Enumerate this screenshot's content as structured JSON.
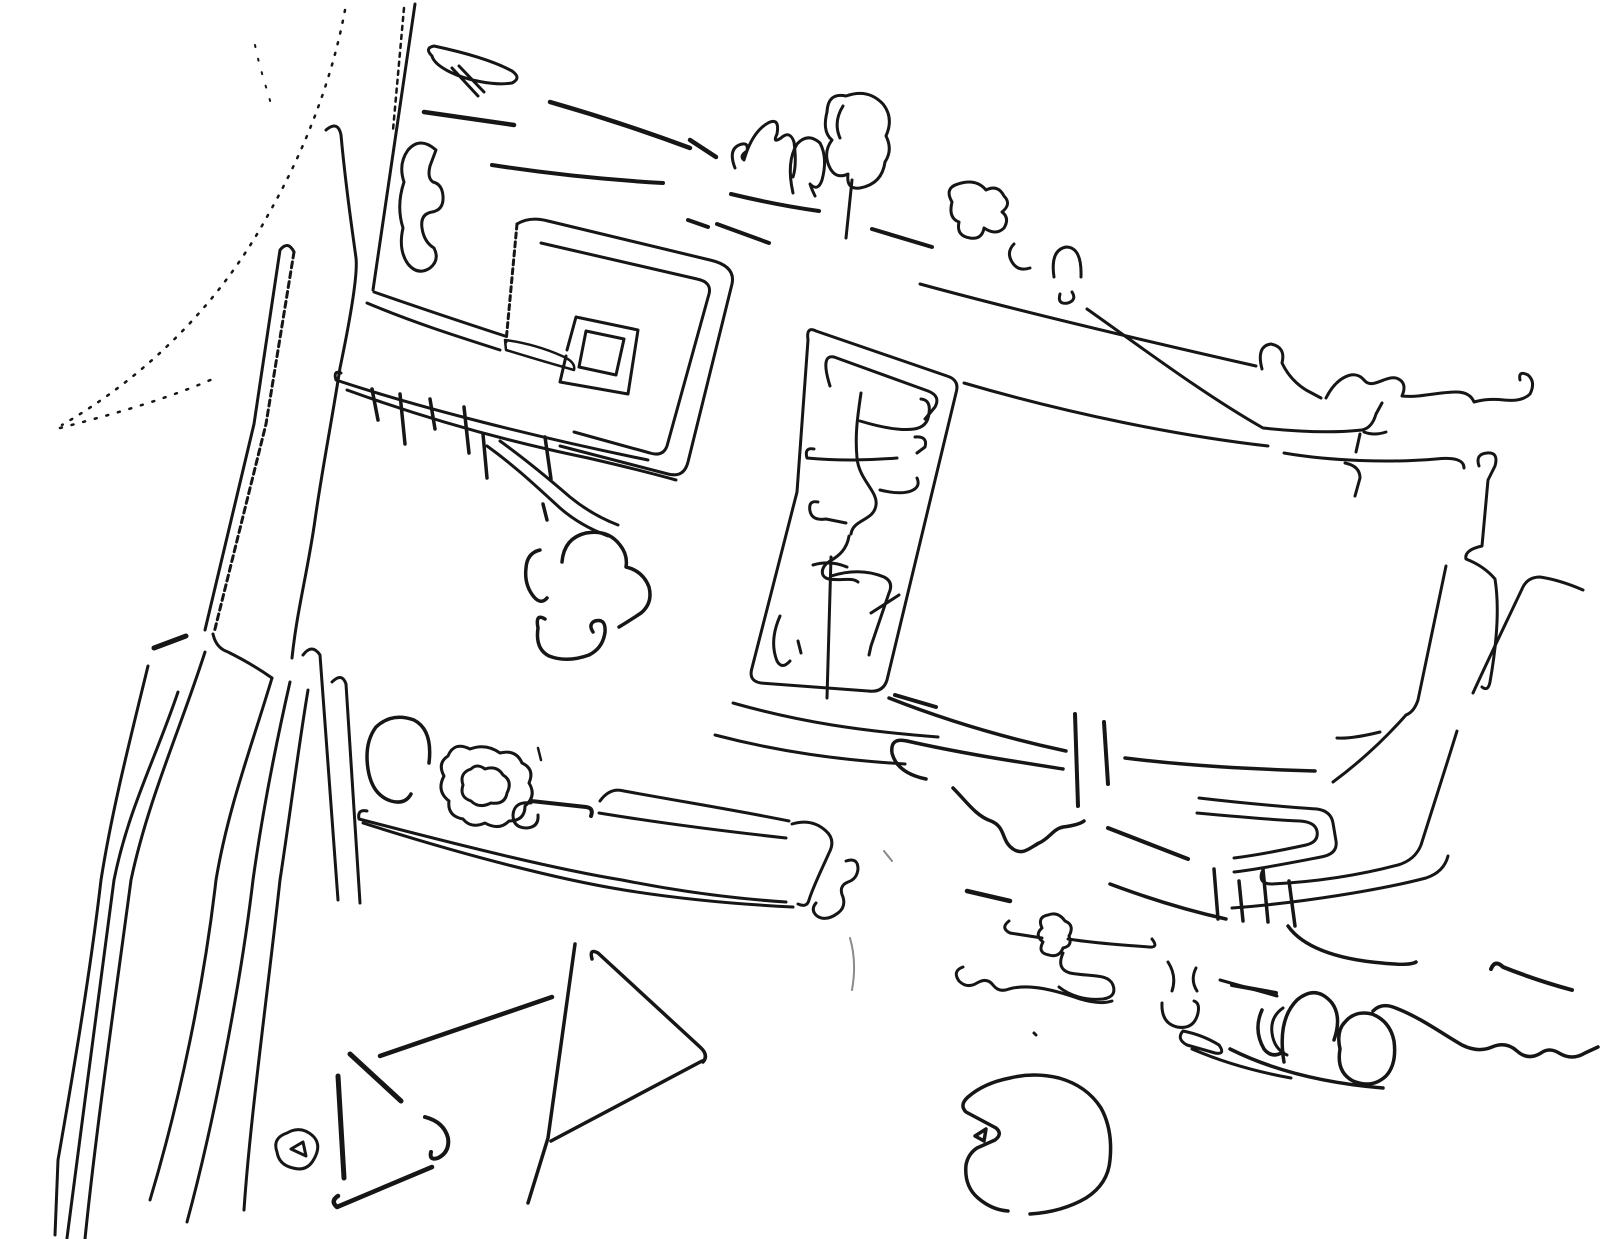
{
  "meta": {
    "background_color": "#ffffff",
    "stroke_color": "#161616",
    "canvas_width": 1600,
    "canvas_height": 1239
  },
  "drawing": {
    "default_stroke_width": 3,
    "paths": [
      {
        "name": "dotted-arc-main",
        "d": "M345,10 C332,80 305,150 268,215 C230,285 165,365 62,425",
        "w": 2.5,
        "dash": "2 9"
      },
      {
        "name": "dotted-arc-lower",
        "d": "M60,428 C110,415 165,400 215,378",
        "w": 2.5,
        "dash": "2 10"
      },
      {
        "name": "dotted-bits-top",
        "d": "M255,45 C260,70 268,92 272,108",
        "w": 2,
        "dash": "2 12"
      },
      {
        "name": "road-left-median-a",
        "d": "M294,252 Q288,240 280,250 L254,424 L205,630",
        "w": 3
      },
      {
        "name": "road-left-median-b",
        "d": "M294,252 L266,424 L214,633",
        "w": 3,
        "dash": "6 4"
      },
      {
        "name": "road-left-right-edge",
        "d": "M326,130 Q338,120 341,135 C346,190 352,228 356,258 C358,275 350,320 340,368 C332,420 322,470 315,520 C308,570 297,610 292,658",
        "w": 3
      },
      {
        "name": "road-left-diagonal",
        "d": "M415,4 L373,290",
        "w": 3
      },
      {
        "name": "road-left-diagonal-edge",
        "d": "M404,8 L393,130",
        "w": 2.5,
        "dash": "4 5"
      },
      {
        "name": "junction-dash",
        "d": "M154,648 L186,636",
        "w": 5
      },
      {
        "name": "junction-link",
        "d": "M213,634 Q216,648 228,652 C244,660 258,668 272,678",
        "w": 3
      },
      {
        "name": "lower-band-1",
        "d": "M148,666 C130,740 112,810 101,880 C90,975 72,1080 58,1160 L55,1235",
        "w": 3
      },
      {
        "name": "lower-band-2",
        "d": "M178,692 C155,760 128,810 114,880 C100,990 82,1120 67,1238",
        "w": 3
      },
      {
        "name": "lower-band-3",
        "d": "M205,652 C180,730 148,800 131,880 C115,1000 96,1130 85,1239",
        "w": 3
      },
      {
        "name": "lower-band-4",
        "d": "M272,678 C252,745 228,808 216,880 C204,985 180,1100 150,1200",
        "w": 3
      },
      {
        "name": "lower-band-5",
        "d": "M290,682 C275,748 262,815 253,880 C240,990 212,1130 187,1222",
        "w": 3
      },
      {
        "name": "lower-band-6",
        "d": "M308,690 C298,750 290,815 280,880 C268,990 250,1120 244,1210",
        "w": 3
      },
      {
        "name": "lower-band-7",
        "d": "M303,655 Q312,643 320,655 L338,900",
        "w": 3
      },
      {
        "name": "lower-band-8",
        "d": "M332,682 Q342,672 346,684 L360,903",
        "w": 3
      },
      {
        "name": "spiral-outer",
        "d": "M517,224 Q530,216 548,221 L710,260 Q736,266 732,284 L688,462 Q684,478 668,474 L560,446",
        "w": 3
      },
      {
        "name": "spiral-left-edge",
        "d": "M517,224 L506,342",
        "w": 3,
        "dash": "5 4"
      },
      {
        "name": "spiral-sliver",
        "d": "M505,340 Q535,344 562,356 Q576,362 574,370 Q545,362 506,350 Z",
        "w": 2.5
      },
      {
        "name": "spiral-mid-ring",
        "d": "M541,243 L697,279 Q712,282 709,294 L667,446 Q663,457 650,453 L574,432",
        "w": 3
      },
      {
        "name": "spiral-inner-square",
        "d": "M567,350 L576,317 L638,330 L628,394 L560,382 L566,356",
        "w": 3
      },
      {
        "name": "spiral-inner-hole",
        "d": "M586,331 L624,339 L616,375 L579,367 Z",
        "w": 3
      },
      {
        "name": "band-junction-spiral-a",
        "d": "M374,292 C420,308 462,322 505,336",
        "w": 3
      },
      {
        "name": "band-junction-spiral-b",
        "d": "M367,303 C412,322 456,336 500,350",
        "w": 3
      },
      {
        "name": "band-lower-a",
        "d": "M341,373 Q333,370 336,380 C420,408 540,438 648,460",
        "w": 3
      },
      {
        "name": "band-lower-b",
        "d": "M347,390 C430,420 510,442 588,458 Q640,470 676,480",
        "w": 3
      },
      {
        "name": "band-ext-a",
        "d": "M487,446 C515,466 538,488 560,508 C576,522 592,530 608,536",
        "w": 3
      },
      {
        "name": "band-ext-b",
        "d": "M500,441 C525,459 548,478 570,497 Q592,515 618,525",
        "w": 3
      },
      {
        "name": "hanging-legs",
        "d": "M372,389 L378,420 M400,394 L405,444 M430,399 L435,429 M464,407 L469,453 M483,434 L487,478 M545,437 L551,479 M543,504 L547,520",
        "w": 3.5
      },
      {
        "name": "top-road-dash-1",
        "d": "M424,112 L514,125",
        "w": 4.5
      },
      {
        "name": "top-road-dash-2",
        "d": "M550,102 Q620,122 690,148",
        "w": 4.5
      },
      {
        "name": "top-road-dash-3",
        "d": "M492,165 C550,174 610,180 663,183",
        "w": 4
      },
      {
        "name": "top-road-dash-4",
        "d": "M690,140 L716,157",
        "w": 4.5
      },
      {
        "name": "top-road-dash-5",
        "d": "M731,194 C760,201 790,207 819,211",
        "w": 4
      },
      {
        "name": "top-road-dash-6",
        "d": "M688,220 L708,227",
        "w": 4
      },
      {
        "name": "top-road-dash-7",
        "d": "M717,224 C736,231 753,237 769,243",
        "w": 4
      },
      {
        "name": "top-road-dash-8",
        "d": "M872,229 L932,247",
        "w": 4
      },
      {
        "name": "long-line-upper",
        "d": "M920,284 C1030,314 1150,342 1256,366 M1262,369 Q1256,346 1271,344 Q1286,347 1282,363 Q1290,380 1306,390 L1321,398",
        "w": 3
      },
      {
        "name": "long-line-mid",
        "d": "M1087,309 C1145,350 1205,395 1263,428 C1300,432 1335,433 1362,430 M1362,430 Q1372,428 1376,414 L1382,403 M1364,432 Q1374,436 1386,432 M1360,434 L1356,452",
        "w": 3
      },
      {
        "name": "long-line-lower",
        "d": "M964,383 C1070,414 1180,436 1268,446 M1284,453 C1330,461 1390,463 1436,459 Q1464,456 1464,468",
        "w": 3
      },
      {
        "name": "hook-down-mid",
        "d": "M1345,463 Q1360,466 1360,478 L1355,496",
        "w": 3
      },
      {
        "name": "wiggle-right-top",
        "d": "M1326,398 C1336,378 1354,368 1364,380 C1372,390 1384,376 1396,378 Q1408,382 1402,396 C1418,398 1438,392 1456,392 Q1470,392 1474,402 Q1488,398 1504,400 Q1522,402 1530,394 Q1536,382 1528,375 Q1518,370 1520,380",
        "w": 3
      },
      {
        "name": "tree-curl",
        "d": "M436,150 Q420,136 408,150 Q398,164 404,182 Q396,206 403,228 Q398,250 408,264 Q418,276 430,268 Q440,260 434,248 Q424,242 422,228 Q420,214 432,212 Q444,210 443,196 Q442,184 433,182 Q427,178 430,166 Z",
        "w": 3
      },
      {
        "name": "tree-hook-blob",
        "d": "M432,56 Q424,48 434,46 C462,52 492,60 512,71 Q522,78 512,83 C494,86 466,80 450,72 Q434,64 432,56 Z M452,68 L478,96 M459,66 L484,92",
        "w": 3
      },
      {
        "name": "tree-two-bump",
        "d": "M735,168 Q728,150 739,145 Q749,141 747,151 Q739,156 744,160 Q752,132 768,123 Q780,117 777,134 Q772,144 781,138 Q790,130 794,142 Q797,165 793,177",
        "w": 3
      },
      {
        "name": "tree-arch",
        "d": "M793,193 Q786,162 797,144 Q808,132 820,143 Q828,158 822,180 Q818,192 810,184 Q812,190 815,196",
        "w": 3
      },
      {
        "name": "tree-big-blob",
        "d": "M846,96 Q828,92 827,112 Q822,132 832,140 Q823,152 829,166 Q835,180 848,174 Q846,190 860,188 Q882,184 885,162 Q893,150 886,136 Q894,118 883,104 Q868,88 846,96 Z M843,106 Q833,122 840,138 M852,180 L846,238",
        "w": 3
      },
      {
        "name": "tree-cluster-right",
        "d": "M952,202 Q944,188 958,184 Q976,178 986,190 Q998,184 1004,196 Q1012,204 1002,212 Q1010,218 1004,228 Q996,236 984,228 Q982,240 970,238 Q956,236 959,222 Q948,218 952,202 Z M1014,244 Q1006,252 1012,262 Q1018,272 1030,268 M1054,277 Q1050,250 1066,247 Q1082,247 1081,277 M1060,294 Q1057,305 1068,303 Q1077,300 1072,292",
        "w": 3
      },
      {
        "name": "parcel-outline",
        "d": "M816,331 Q806,326 808,340 L797,492 L752,668 Q748,681 761,683 L868,691 Q883,693 887,680 L956,393 Q960,380 947,376 Z",
        "w": 3
      },
      {
        "name": "parcel-top-bar",
        "d": "M830,386 Q820,354 834,357 L928,391 Q941,396 935,407 L925,419",
        "w": 3
      },
      {
        "name": "parcel-branches-upper",
        "d": "M861,393 C857,420 855,436 857,458 C859,480 878,491 876,505 C874,521 853,519 851,534 M860,421 C880,427 900,431 914,429 Q928,427 929,413 Q931,400 921,399 M814,449 Q804,447 807,458 Q850,462 897,458 M915,437 Q928,436 925,447 L917,453 M880,490 Q900,495 911,491 Q921,487 917,478 M818,502 Q808,500 810,511 Q812,521 826,519 L846,523",
        "w": 3
      },
      {
        "name": "parcel-mid-squiggle",
        "d": "M849,536 C847,549 839,556 830,561 C821,566 819,577 829,579 C841,581 852,577 858,582",
        "w": 3
      },
      {
        "name": "parcel-wishbone",
        "d": "M831,557 L827,698 M831,576 Q860,567 884,577 Q894,582 889,593 L871,646 L869,655 M871,613 L899,595 M813,565 Q830,560 847,567",
        "w": 3
      },
      {
        "name": "parcel-left-curve",
        "d": "M780,616 Q769,641 777,661 Q782,670 790,661 M798,641 L801,653",
        "w": 3
      },
      {
        "name": "parcel-bottom-line-1",
        "d": "M733,703 C800,722 860,731 938,737",
        "w": 3
      },
      {
        "name": "parcel-bottom-line-2",
        "d": "M715,735 C780,752 840,760 905,764",
        "w": 3
      },
      {
        "name": "parcel-bottom-dash",
        "d": "M895,695 L936,707",
        "w": 4
      },
      {
        "name": "road-mr-1",
        "d": "M889,698 C950,722 1010,739 1066,751",
        "w": 3.5
      },
      {
        "name": "road-mr-hook",
        "d": "M926,779 Q897,773 892,753 Q890,737 907,741 C960,753 1012,761 1063,769",
        "w": 3.5
      },
      {
        "name": "road-mr-right",
        "d": "M1125,758 C1190,766 1250,769 1315,771",
        "w": 3.5
      },
      {
        "name": "bar-vertical-1",
        "d": "M1075,714 L1078,806",
        "w": 4
      },
      {
        "name": "bar-vertical-2",
        "d": "M1104,722 L1108,784",
        "w": 4
      },
      {
        "name": "wavy-wm",
        "d": "M953,788 C966,801 976,816 991,821 C1006,827 1001,841 1013,849 C1023,856 1031,847 1039,843 C1049,839 1053,829 1063,827 Q1079,825 1084,821",
        "w": 3.5
      },
      {
        "name": "dash-diагonal-mr",
        "d": "M1108,828 L1188,859",
        "w": 4
      },
      {
        "name": "step-band-a",
        "d": "M1199,798 C1250,804 1300,808 1317,809 Q1331,811 1333,823 L1336,841 Q1338,854 1321,857 C1290,863 1260,869 1234,872",
        "w": 3
      },
      {
        "name": "step-band-b",
        "d": "M1197,813 C1240,817 1275,820 1300,821 Q1315,822 1317,831 Q1319,842 1306,845 C1283,850 1258,855 1234,858",
        "w": 3
      },
      {
        "name": "bottom-line-mr",
        "d": "M1110,884 C1150,899 1190,911 1226,919",
        "w": 3.5
      },
      {
        "name": "stubs-vertical",
        "d": "M1214,869 L1218,919 M1239,881 L1243,921",
        "w": 3.5
      },
      {
        "name": "field-right-edge",
        "d": "M1446,566 L1418,700 Q1414,712 1406,715 C1384,740 1360,762 1333,782",
        "w": 3
      },
      {
        "name": "field-right-inner",
        "d": "M1380,732 Q1352,739 1337,738",
        "w": 3
      },
      {
        "name": "field-right-branch",
        "d": "M1457,731 C1445,770 1432,810 1421,845 Q1415,860 1398,865 C1360,875 1315,882 1272,884 Q1258,884 1262,872",
        "w": 3
      },
      {
        "name": "field-right-branch-b",
        "d": "M1448,856 Q1444,872 1426,878 C1380,890 1300,903 1232,908",
        "w": 3
      },
      {
        "name": "shape-five",
        "d": "M1479,466 Q1475,454 1487,453 Q1499,452 1495,466 L1488,480 L1482,546 Q1464,550 1466,559 Q1484,566 1495,579 C1500,610 1496,648 1490,682 Q1488,692 1482,687",
        "w": 3
      },
      {
        "name": "elbow-right",
        "d": "M1583,590 Q1560,580 1540,577 Q1527,577 1522,589 C1505,625 1488,660 1473,693",
        "w": 3
      },
      {
        "name": "ring-open",
        "d": "M429,763 Q433,730 414,720 Q392,712 376,727 Q364,743 368,769 Q372,795 391,801 Q405,805 411,794",
        "w": 3.5
      },
      {
        "name": "flower-outer",
        "d": "M470,749 Q454,741 448,756 Q437,763 444,776 Q436,791 449,801 Q447,816 463,819 Q471,829 485,823 Q499,831 509,821 Q525,821 525,806 Q537,796 529,783 Q535,769 522,763 Q516,749 500,753 Q486,743 470,749 Z",
        "w": 3
      },
      {
        "name": "flower-hole",
        "d": "M471,769 Q459,773 463,785 Q459,797 471,801 Q479,809 491,803 Q505,805 507,793 Q513,781 503,775 Q497,765 485,769 Q477,763 471,769 Z",
        "w": 3
      },
      {
        "name": "small-circle",
        "d": "M531,803 Q514,801 513,815 Q513,828 527,828 Q539,827 538,815",
        "w": 3
      },
      {
        "name": "bar-from-flower",
        "d": "M531,801 L586,807 Q594,808 591,816",
        "w": 4
      },
      {
        "name": "tiny-tick",
        "d": "M538,748 L541,760",
        "w": 2.5
      },
      {
        "name": "road-up-a",
        "d": "M600,801 Q610,787 624,791 C690,803 740,811 789,821",
        "w": 3
      },
      {
        "name": "road-up-b",
        "d": "M599,813 C660,823 722,831 786,838",
        "w": 3
      },
      {
        "name": "s-hook-road-end",
        "d": "M792,824 Q812,818 826,831 Q836,840 829,853 C821,871 813,887 809,900 Q807,908 798,904",
        "w": 3
      },
      {
        "name": "road-low-a",
        "d": "M367,811 Q357,809 359,819 C470,848 560,870 622,880 C682,892 740,899 786,902",
        "w": 3
      },
      {
        "name": "road-low-b",
        "d": "M363,823 C470,857 562,880 624,890 C680,899 732,904 793,907",
        "w": 3
      },
      {
        "name": "squiggle-tail",
        "d": "M846,861 Q858,857 858,869 Q857,879 848,882 Q838,886 843,897 Q846,907 838,913 Q826,922 817,916 Q810,910 816,903",
        "w": 3
      },
      {
        "name": "trefoil-blob",
        "d": "M540,550 Q527,553 526,568 Q524,585 534,597 Q541,605 547,598 M562,562 Q564,538 586,533 Q608,529 620,545 Q628,555 626,567 Q643,571 649,587 Q653,603 641,613 Q629,621 619,627 M545,619 Q535,613 538,628 Q535,649 549,656 Q567,663 589,655 Q603,648 605,632 Q606,618 595,621 Q588,624 593,632",
        "w": 3.5
      },
      {
        "name": "triangle-small",
        "d": "M277,1152 Q272,1138 287,1133 Q301,1125 313,1136 Q322,1145 314,1159 Q307,1172 293,1168 Q279,1165 277,1152 Z M291,1149 L303,1142 L306,1156 Z",
        "w": 3
      },
      {
        "name": "bar-bottom-left",
        "d": "M338,1076 L344,1178",
        "w": 5
      },
      {
        "name": "dash-diag-bl",
        "d": "M350,1054 L401,1101",
        "w": 5
      },
      {
        "name": "long-diag-bl",
        "d": "M380,1056 L552,997",
        "w": 4.5
      },
      {
        "name": "hook-bl",
        "d": "M425,1117 Q444,1122 448,1138 Q450,1152 438,1158 Q429,1161 431,1152",
        "w": 4
      },
      {
        "name": "dash-bottom-bl",
        "d": "M338,1196 Q330,1201 337,1207 L432,1167",
        "w": 4.5
      },
      {
        "name": "triangle-left-line",
        "d": "M575,944 L548,1138 L528,1203",
        "w": 3.5
      },
      {
        "name": "triangle-top-side",
        "d": "M592,959 Q589,948 598,953 L700,1047 Q709,1055 703,1062",
        "w": 3.5
      },
      {
        "name": "triangle-hypotenuse",
        "d": "M702,1061 L551,1141",
        "w": 3.5
      },
      {
        "name": "dash-bottom-mid",
        "d": "M967,891 L1010,901",
        "w": 4.5
      },
      {
        "name": "squiggle-row",
        "d": "M1009,921 Q1000,928 1010,933 L1042,938 M1048,915 Q1037,917 1042,928 Q1034,935 1043,942 Q1037,953 1049,955 Q1059,958 1063,948 Q1073,946 1069,936 Q1075,925 1065,921 Q1058,911 1048,915 Z M1068,939 C1100,944 1126,945 1149,947 Q1159,948 1152,939 M1063,953 Q1056,969 1070,973 C1090,977 1108,973 1113,985 Q1117,997 1103,999 C1085,1001 1069,995 1059,987 M963,967 Q952,971 959,981 Q967,989 977,983 Q987,977 993,985 Q999,993 1009,989 C1030,983 1058,991 1080,999 Q1100,1005 1112,1001 M1168,962 Q1177,976 1172,991 M1196,968 Q1190,980 1197,991 M1220,980 L1277,996 M1162,1003 Q1161,1023 1177,1027 Q1194,1030 1198,1013 Q1200,1003 1194,1001 M1183,1031 Q1176,1039 1187,1045 L1215,1053 Q1226,1055 1219,1045 Q1203,1035 1183,1031 M1283,1008 Q1270,1017 1272,1033 Q1274,1049 1287,1055 M1192,1049 C1220,1061 1252,1071 1291,1078",
        "w": 3
      },
      {
        "name": "pentagon-blob",
        "d": "M1010,1078 Q984,1083 968,1097 Q959,1105 966,1112 L996,1128 Q1003,1134 995,1140 L977,1148 Q968,1154 966,1165 Q964,1186 978,1198 Q992,1210 1008,1211 M1030,1214 Q1062,1212 1086,1198 Q1108,1184 1110,1160 Q1113,1130 1101,1108 Q1087,1086 1059,1078 Q1034,1072 1010,1078 M975,1136 L986,1129 L984,1141 Z",
        "w": 3.5
      },
      {
        "name": "curve-bottom-right",
        "d": "M1288,926 C1302,946 1334,959 1382,963 Q1410,966 1416,962",
        "w": 3.5
      },
      {
        "name": "bars-bottom-right",
        "d": "M1263,869 L1268,922 M1289,881 L1295,926",
        "w": 3.5
      },
      {
        "name": "dash-br-right",
        "d": "M1491,969 Q1495,959 1503,967 C1528,977 1550,984 1572,990",
        "w": 4
      },
      {
        "name": "dash-br-left",
        "d": "M1232,985 L1276,993",
        "w": 4
      },
      {
        "name": "loops-bottom-right",
        "d": "M1284,1062 Q1277,1020 1297,1000 Q1316,984 1332,1003 Q1342,1017 1334,1040 M1262,1010 Q1253,1030 1264,1049 Q1272,1059 1283,1052 M1345,1022 Q1336,1031 1340,1049 Q1336,1072 1353,1081 Q1372,1089 1386,1076 Q1397,1064 1394,1041 Q1390,1021 1372,1014 Q1355,1010 1345,1022 M1230,1049 C1270,1069 1322,1083 1383,1088",
        "w": 3.5
      },
      {
        "name": "wavy-bottom-right",
        "d": "M1373,1011 Q1381,1003 1393,1007 C1420,1017 1441,1033 1462,1045 Q1478,1053 1492,1047 Q1506,1041 1517,1051 Q1528,1061 1541,1053 Q1549,1047 1559,1053 Q1572,1061 1585,1053 L1598,1047",
        "w": 3.5
      },
      {
        "name": "tiny-dot",
        "d": "M1034,1033 l2,2",
        "w": 3
      },
      {
        "name": "faint-smudge",
        "d": "M850,938 Q857,962 852,990 M884,851 l8,10",
        "w": 2,
        "color": "#c8c8c8",
        "opacity": 0.5
      }
    ]
  }
}
